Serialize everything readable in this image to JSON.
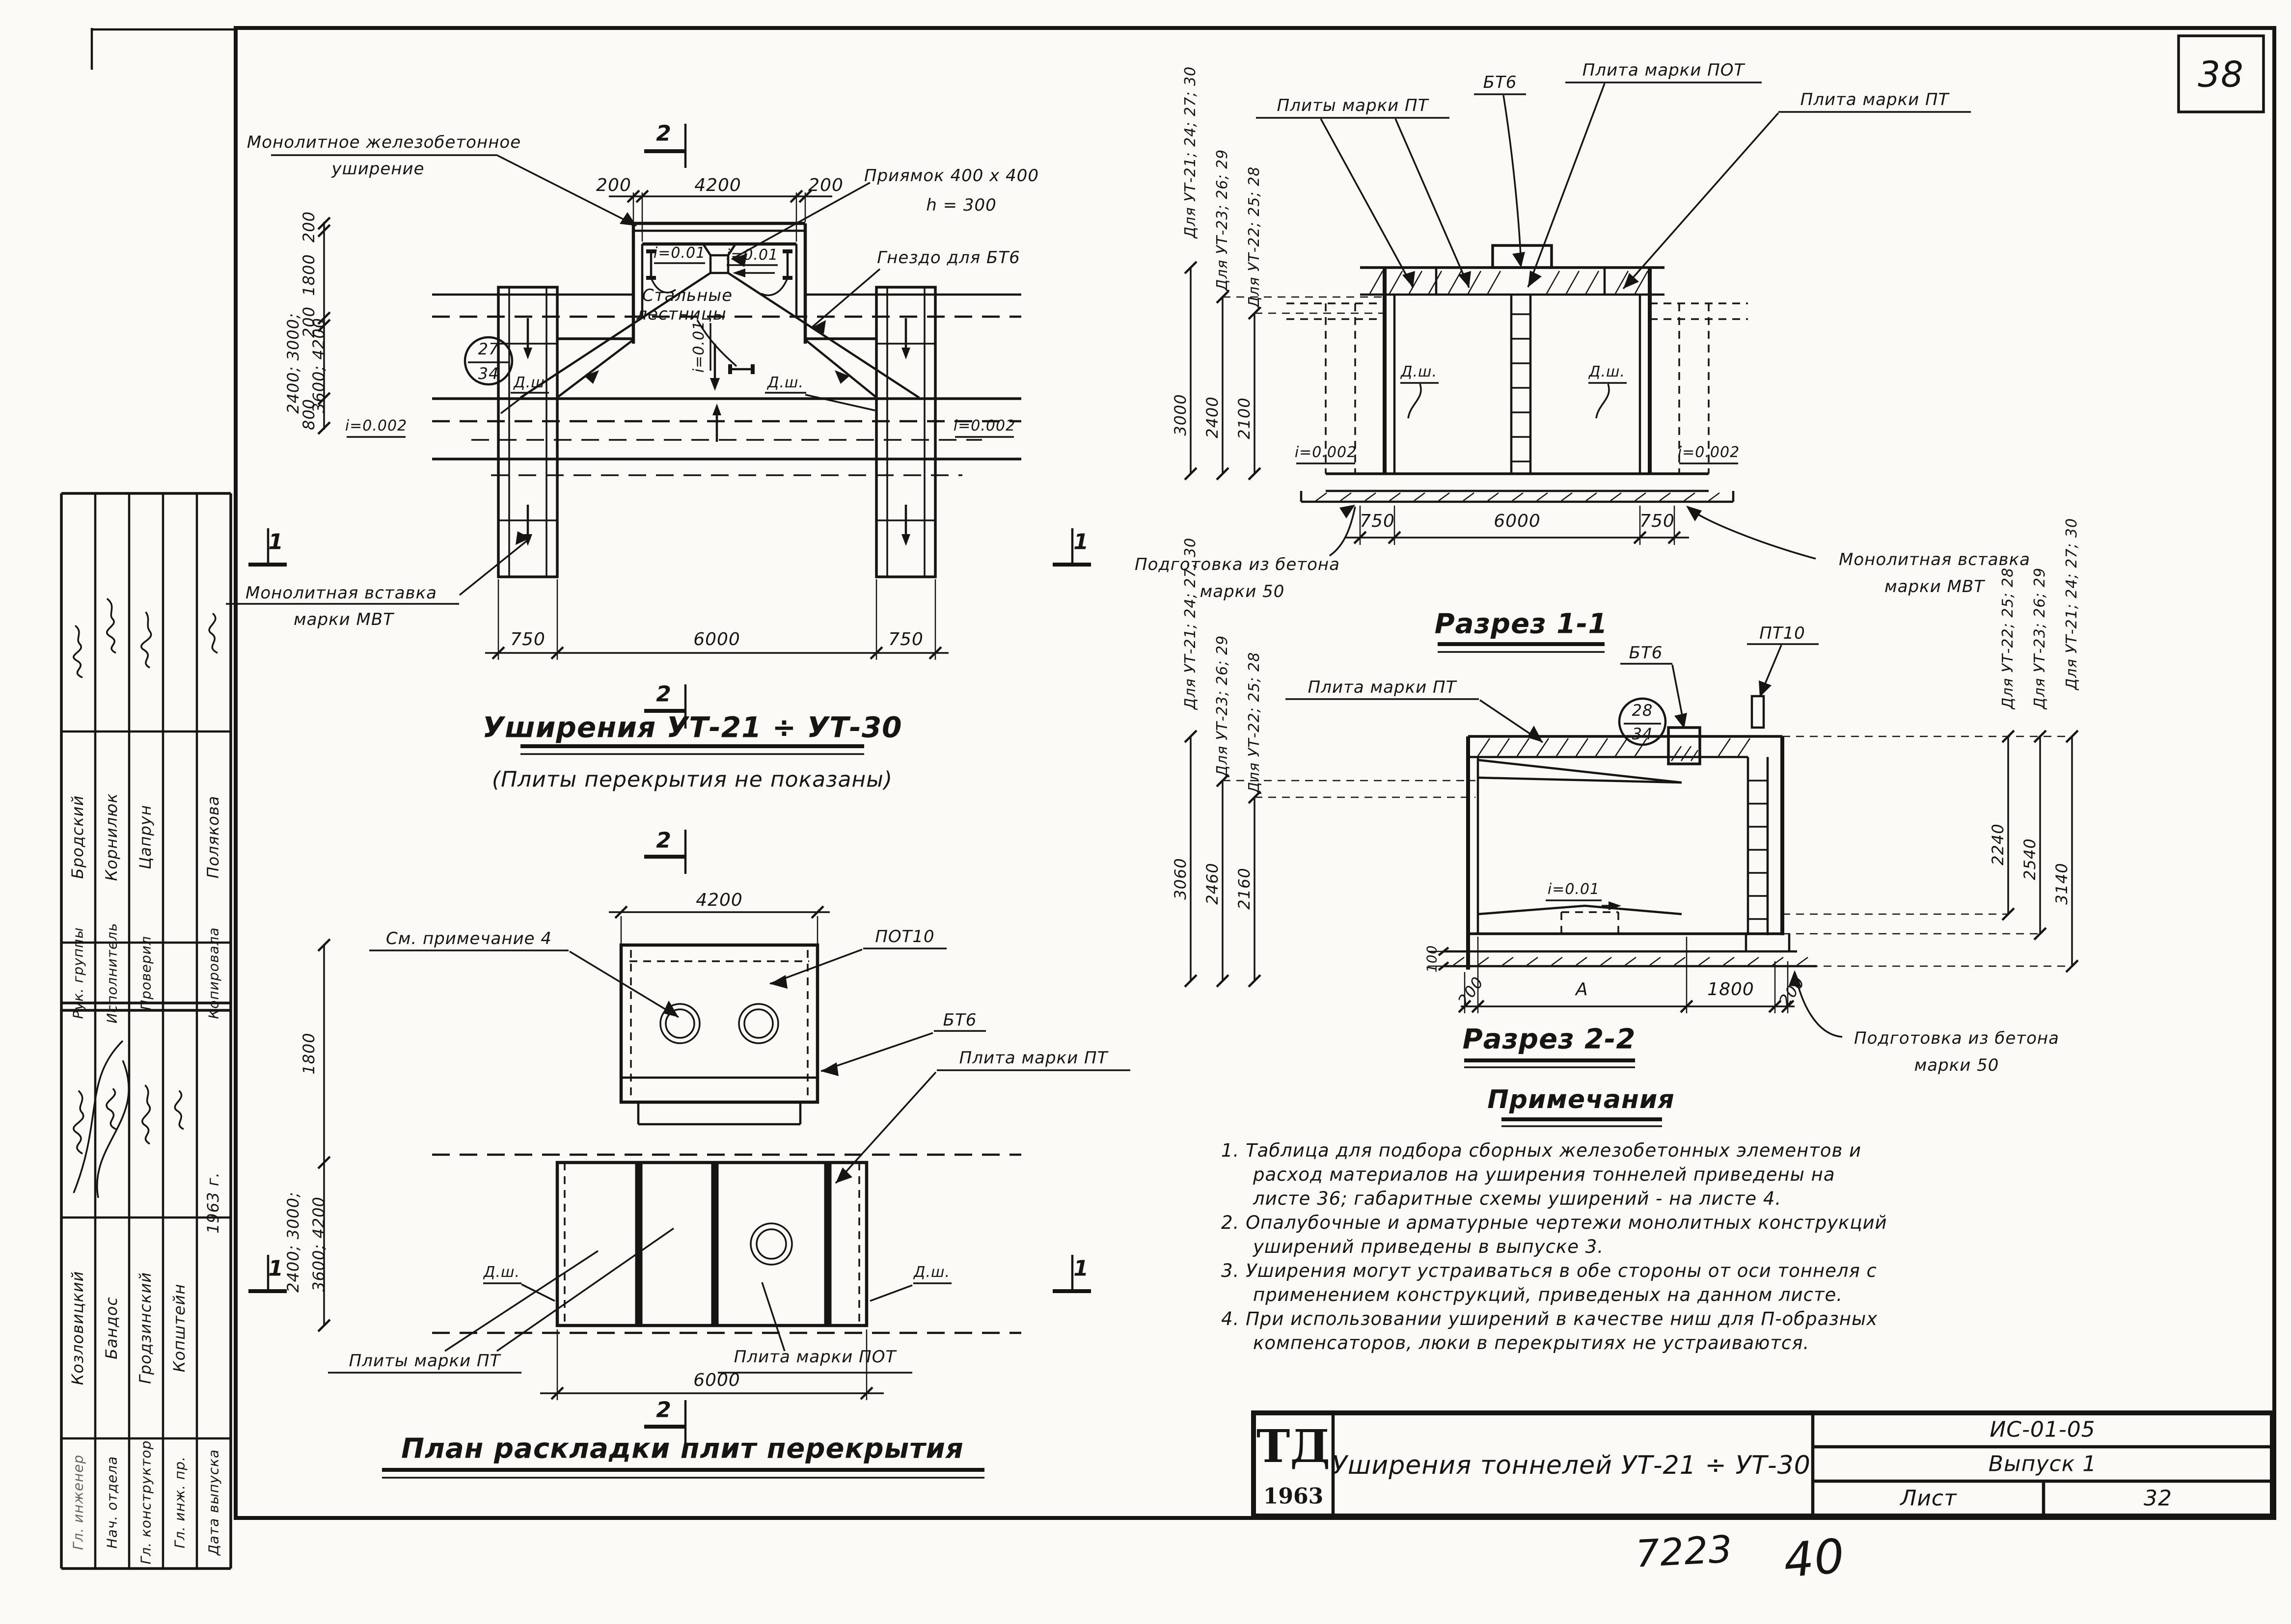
{
  "page": {
    "sheet_number": "38",
    "handwritten_code": "7223",
    "handwritten_num": "40"
  },
  "sidebar": {
    "group_a": {
      "rows": [
        {
          "title": "Рук. группы",
          "name": "Бродский"
        },
        {
          "title": "Исполнитель",
          "name": "Корнилюк"
        },
        {
          "title": "Проверил",
          "name": "Цапрун"
        },
        {
          "title": "",
          "name": ""
        },
        {
          "title": "Копировала",
          "name": "Полякова"
        }
      ]
    },
    "group_b": {
      "rows": [
        {
          "title": "Гл. инженер",
          "name": "Козловицкий"
        },
        {
          "title": "Нач. отдела",
          "name": "Бандос"
        },
        {
          "title": "Гл. конструктор",
          "name": "Гродзинский"
        },
        {
          "title": "Гл. инж. пр.",
          "name": "Копштейн"
        },
        {
          "title": "Дата выпуска",
          "name": "1963 г."
        }
      ]
    }
  },
  "plan_widening": {
    "title": "Уширения  УТ-21 ÷ УТ-30",
    "subtitle": "(Плиты  перекрытия  не  показаны)",
    "labels": {
      "monolithic_1": "Монолитное  железобетонное",
      "monolithic_2": "уширение",
      "pit": "Приямок  400 х 400",
      "pit_h": "h = 300",
      "socket": "Гнездо  для  БТ6",
      "ladders_1": "Стальные",
      "ladders_2": "лестницы",
      "insert_1": "Монолитная  вставка",
      "insert_2": "марки  МВТ",
      "joint_left": "Д.ш",
      "joint_right": "Д.ш.",
      "slope_top_left": "i=0.01",
      "slope_top_right": "i=0.01",
      "slope_center": "i=0.01",
      "slope_left": "i=0.002",
      "slope_right": "i=0.002"
    },
    "marker": {
      "top": "27",
      "bottom": "34"
    },
    "dims": {
      "top": [
        "200",
        "4200",
        "200"
      ],
      "left": [
        "200",
        "1800",
        "200",
        "2400; 3000;",
        "3600; 4200",
        "800"
      ],
      "bottom": [
        "750",
        "6000",
        "750"
      ]
    },
    "sections": {
      "s2": "2",
      "s1": "1"
    }
  },
  "section_1_1": {
    "title": "Разрез  1-1",
    "labels": {
      "plates_pt": "Плиты  марки  ПТ",
      "bt6": "БТ6",
      "plate_pot": "Плита  марки  ПОТ",
      "plate_pt": "Плита  марки  ПТ",
      "joint_left": "Д.ш.",
      "joint_right": "Д.ш.",
      "slope_left": "i=0.002",
      "slope_right": "i=0.002",
      "prep_1": "Подготовка  из  бетона",
      "prep_2": "марки  50",
      "insert_1": "Монолитная  вставка",
      "insert_2": "марки  МВТ"
    },
    "variants": [
      "Для УТ-21; 24; 27; 30",
      "Для УТ-23; 26; 29",
      "Для УТ-22; 25; 28"
    ],
    "heights": [
      "3000",
      "2400",
      "2100"
    ],
    "dims_bottom": [
      "750",
      "6000",
      "750"
    ]
  },
  "plan_slabs": {
    "title": "План  раскладки  плит  перекрытия",
    "labels": {
      "note_ref": "См. примечание 4",
      "pot10": "ПОТ10",
      "bt6": "БТ6",
      "plate_pt": "Плита  марки  ПТ",
      "plates_pt": "Плиты  марки  ПТ",
      "plate_pot": "Плита  марки  ПОТ",
      "joint_left": "Д.ш.",
      "joint_right": "Д.ш."
    },
    "dims": {
      "top": "4200",
      "left": [
        "1800",
        "2400; 3000;",
        "3600; 4200"
      ],
      "bottom": "6000"
    },
    "sections": {
      "s1": "1",
      "s2": "2"
    }
  },
  "section_2_2": {
    "title": "Разрез  2-2",
    "labels": {
      "plate_pt": "Плита  марки  ПТ",
      "bt6": "БТ6",
      "pt10": "ПТ10",
      "slope": "i=0.01",
      "prep_1": "Подготовка  из  бетона",
      "prep_2": "марки  50"
    },
    "marker": {
      "top": "28",
      "bottom": "34"
    },
    "left_variants": [
      "Для УТ-21; 24; 27; 30",
      "Для УТ-23; 26; 29",
      "Для УТ-22; 25; 28"
    ],
    "left_heights": [
      "3060",
      "2460",
      "2160"
    ],
    "right_variants": [
      "Для УТ-22; 25; 28",
      "Для УТ-23; 26; 29",
      "Для УТ-21; 24; 27; 30"
    ],
    "right_heights": [
      "2240",
      "2540",
      "3140"
    ],
    "dims_bottom": [
      "200",
      "А",
      "1800",
      "200"
    ],
    "dim_prep": "100"
  },
  "notes": {
    "heading": "Примечания",
    "lines": [
      "1. Таблица  для  подбора  сборных  железобетонных  элементов  и",
      "расход  материалов  на  уширения  тоннелей  приведены  на",
      "листе  36;  габаритные  схемы  уширений - на  листе  4.",
      "2. Опалубочные  и  арматурные  чертежи  монолитных  конструкций",
      "уширений  приведены  в  выпуске  3.",
      "3. Уширения  могут  устраиваться  в  обе  стороны  от  оси  тоннеля  с",
      "применением  конструкций,  приведеных  на  данном  листе.",
      "4. При  использовании  уширений  в  качестве  ниш  для  П-образных",
      "компенсаторов,  люки  в  перекрытиях  не  устраиваются."
    ]
  },
  "title_block": {
    "logo": "ТД",
    "logo_year": "1963",
    "title": "Уширения  тоннелей  УТ-21 ÷ УТ-30",
    "code": "ИС-01-05",
    "issue": "Выпуск 1",
    "sheet_label": "Лист",
    "sheet_number": "32"
  }
}
